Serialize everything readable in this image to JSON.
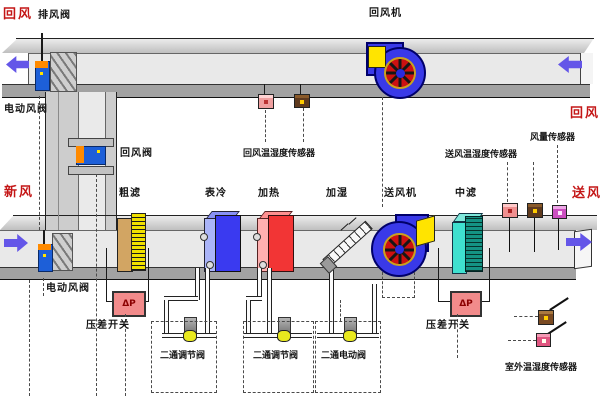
{
  "colors": {
    "accent_red": "#c41616",
    "arrow_blue": "#6456e8",
    "valve_blue": "#1d5fd8",
    "valve_orange": "#ff8a00",
    "fan_blue": "#3939e8",
    "impeller_red": "#cc1111",
    "inlet_yellow": "#ffe400",
    "coarse_filter_tan": "#d2a563",
    "coarse_filter_yellow": "#f0e000",
    "cooler_blue": "#3a3af0",
    "heater_red": "#f23535",
    "mid_filter_teal": "#149384",
    "dp_pink": "#f28b8b",
    "duct_gray": "#e9e9e9"
  },
  "labels": {
    "return_air_top": "回风",
    "exhaust_valve": "排风阀",
    "return_fan": "回风机",
    "return_air_right": "回风",
    "electric_damper_top": "电动风阀",
    "return_damper": "回风阀",
    "return_air_sensor": "回风温湿度传感器",
    "airflow_sensor": "风量传感器",
    "supply_air_sensor": "送风温湿度传感器",
    "fresh_air": "新风",
    "coarse_filter": "粗滤",
    "cooling_coil": "表冷",
    "heating_coil": "加热",
    "humidifier": "加湿",
    "supply_fan": "送风机",
    "mid_filter": "中滤",
    "supply_air": "送风",
    "electric_damper_bottom": "电动风阀",
    "dp_switch_left": "压差开关",
    "dp_switch_right": "压差开关",
    "dp_symbol": "ΔP",
    "valve_cooling": "二通调节阀",
    "valve_heating": "二通调节阀",
    "valve_humidifier": "二通电动阀",
    "outdoor_sensor": "室外温湿度传感器"
  }
}
